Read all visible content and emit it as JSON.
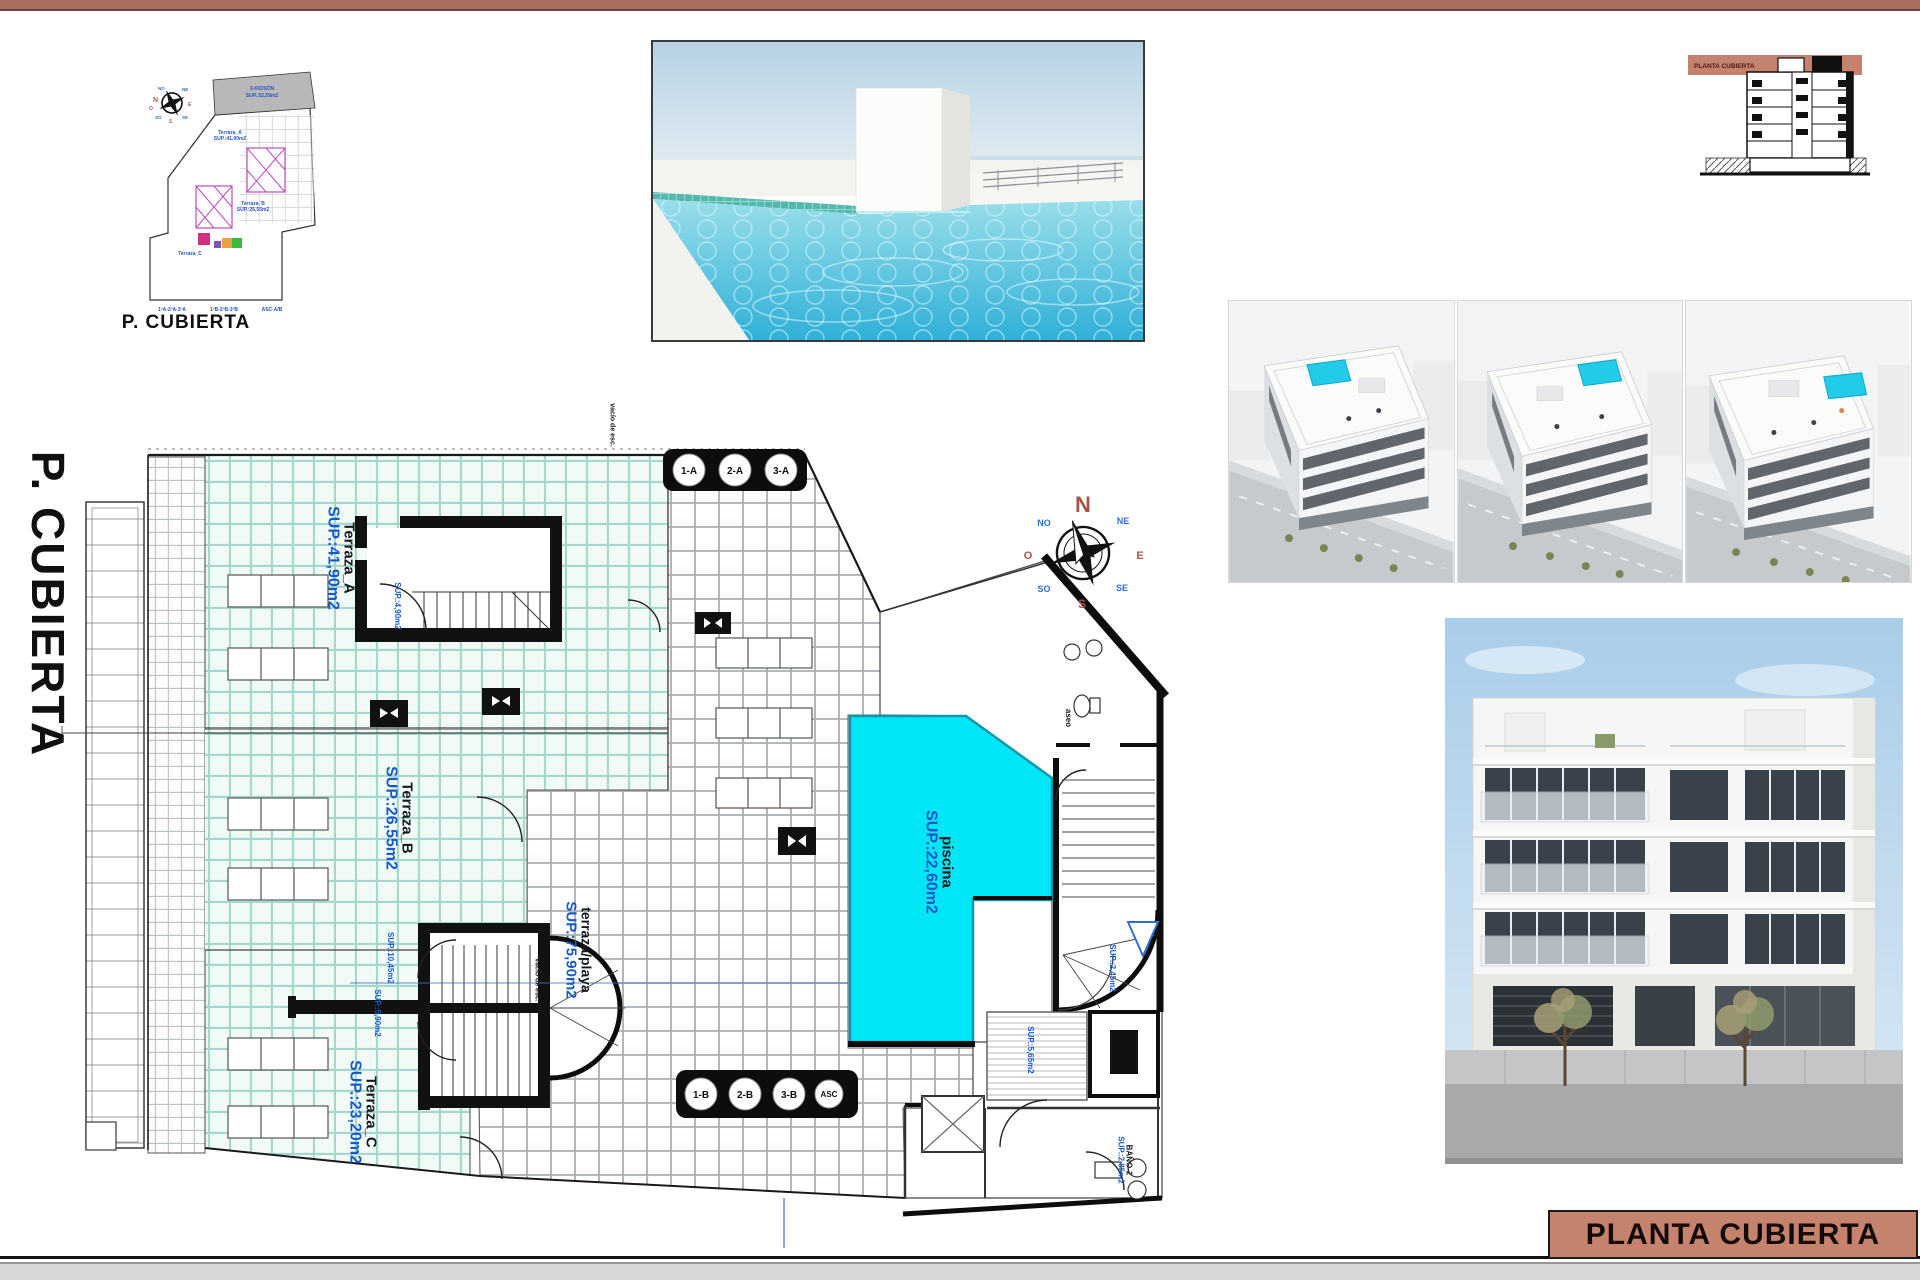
{
  "page": {
    "title_box_label": "PLANTA CUBIERTA",
    "side_label": "P. CUBIERTA",
    "accent_color": "#c5836e",
    "top_bar_color": "#a86e60"
  },
  "site_plan": {
    "caption": "P. CUBIERTA",
    "labels": {
      "parcel1": "3-KIOSÓN",
      "parcel2": "SUP.:52,59m2",
      "a1": "Terraza_A",
      "a2": "SUP.:41,90m2",
      "b1": "Terraza_B",
      "b2": "SUP.:26,55m2",
      "c1": "Terraza_C",
      "row1": "1ºA-2ºA-3ºA",
      "row2": "1ºB-2ºB-3ºB",
      "row3": "ASC-A/B"
    }
  },
  "section": {
    "band_label": "PLANTA CUBIERTA"
  },
  "compass": {
    "n": "N",
    "ne": "NE",
    "e": "E",
    "se": "SE",
    "s": "S",
    "so": "SO",
    "o": "O",
    "no": "NO"
  },
  "floor_plan": {
    "rooms": [
      {
        "name": "Terraza_A",
        "sup": "SUP.:41,90m2"
      },
      {
        "name": "Terraza_B",
        "sup": "SUP.:26,55m2"
      },
      {
        "name": "Terraza_C",
        "sup": "SUP.:23,20m2"
      },
      {
        "name": "terraza/playa",
        "sup": "SUP.:75,90m2"
      },
      {
        "name": "piscina",
        "sup": "SUP.:22,60m2"
      }
    ],
    "labels": {
      "aseo": "aseo",
      "bano_name": "BAÑO-2",
      "bano_sup": "SUP.:2,85m2",
      "sup_565": "SUP.:5,65m2",
      "sup_245": "SUP.:2,45m2",
      "stair_a_sup": "SUP.:4,90m2",
      "stair_b1_sup": "SUP.:10,45m2",
      "stair_b2_sup": "SUP.:5,90m2",
      "vacio1": "vacío de esc.",
      "vacio2": "vacío de esc."
    },
    "core_a": [
      "1-A",
      "2-A",
      "3-A"
    ],
    "core_b": [
      "1-B",
      "2-B",
      "3-B",
      "ASC"
    ],
    "colors": {
      "pool": "#00e6f6",
      "terrace_tile": "#a5d8cd",
      "label_blue": "#1659c9"
    }
  }
}
